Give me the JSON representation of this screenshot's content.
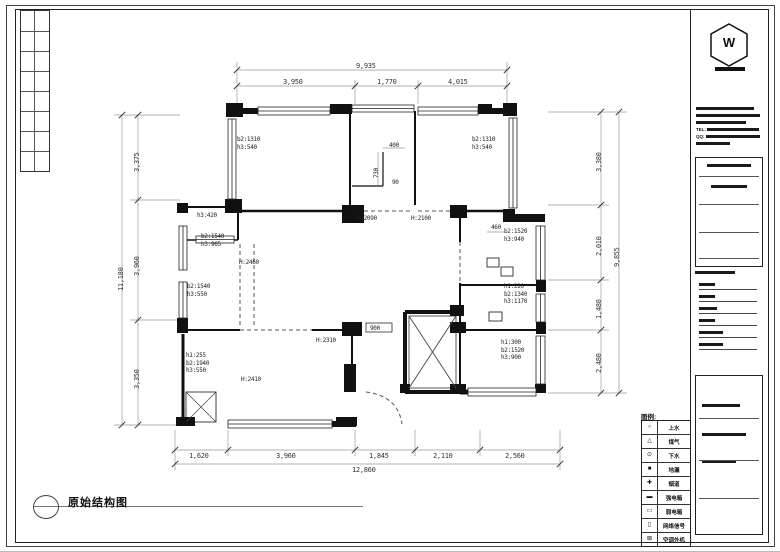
{
  "sheet": {
    "drawing_title": "原始结构图",
    "legend_header": "图例:"
  },
  "title_block": {
    "logo_glyph": "W",
    "tel_label": "TEL:",
    "qq_label": "QQ:"
  },
  "legend_rows": [
    {
      "sym": "○",
      "name": "上水"
    },
    {
      "sym": "△",
      "name": "煤气"
    },
    {
      "sym": "⊙",
      "name": "下水"
    },
    {
      "sym": "■",
      "name": "地漏"
    },
    {
      "sym": "✚",
      "name": "烟道"
    },
    {
      "sym": "▬",
      "name": "强电箱"
    },
    {
      "sym": "▭",
      "name": "弱电箱"
    },
    {
      "sym": "▯",
      "name": "网络信号"
    },
    {
      "sym": "⊠",
      "name": "空调外机"
    }
  ],
  "plan": {
    "labels": [
      {
        "t": "b2:1310\nh3:540",
        "x": 237,
        "y": 136
      },
      {
        "t": "b2:1310\nh3:540",
        "x": 472,
        "y": 136
      },
      {
        "t": "h3:420",
        "x": 197,
        "y": 212
      },
      {
        "t": "b2:1540\nh3:965",
        "x": 201,
        "y": 233
      },
      {
        "t": "H:2460",
        "x": 239,
        "y": 259
      },
      {
        "t": "b2:1540\nh3:550",
        "x": 187,
        "y": 283
      },
      {
        "t": "H:2090",
        "x": 357,
        "y": 215
      },
      {
        "t": "H:2100",
        "x": 411,
        "y": 215
      },
      {
        "t": "b2:1520\nh3:940",
        "x": 504,
        "y": 228
      },
      {
        "t": "h1:220\nb2:1340\nh3:1170",
        "x": 504,
        "y": 283
      },
      {
        "t": "h1:300\nb2:1520\nh3:900",
        "x": 501,
        "y": 339
      },
      {
        "t": "h1:255\nb2:1940\nh3:550",
        "x": 186,
        "y": 352
      },
      {
        "t": "H:2410",
        "x": 241,
        "y": 376
      },
      {
        "t": "H:2310",
        "x": 316,
        "y": 337
      },
      {
        "t": "400",
        "x": 389,
        "y": 142
      },
      {
        "t": "730",
        "x": 373,
        "y": 178,
        "rot": true
      },
      {
        "t": "90",
        "x": 392,
        "y": 179
      },
      {
        "t": "460",
        "x": 491,
        "y": 224
      },
      {
        "t": "900",
        "x": 370,
        "y": 325
      }
    ],
    "dims": [
      {
        "t": "9,935",
        "x": 356,
        "y": 62
      },
      {
        "t": "3,950",
        "x": 283,
        "y": 78
      },
      {
        "t": "1,770",
        "x": 377,
        "y": 78
      },
      {
        "t": "4,015",
        "x": 448,
        "y": 78
      },
      {
        "t": "11,180",
        "x": 117,
        "y": 291,
        "rot": true
      },
      {
        "t": "3,375",
        "x": 133,
        "y": 172,
        "rot": true
      },
      {
        "t": "3,960",
        "x": 133,
        "y": 276,
        "rot": true
      },
      {
        "t": "3,350",
        "x": 133,
        "y": 389,
        "rot": true
      },
      {
        "t": "3,380",
        "x": 595,
        "y": 172,
        "rot": true
      },
      {
        "t": "2,010",
        "x": 595,
        "y": 256,
        "rot": true
      },
      {
        "t": "1,480",
        "x": 595,
        "y": 319,
        "rot": true
      },
      {
        "t": "2,480",
        "x": 595,
        "y": 373,
        "rot": true
      },
      {
        "t": "9,855",
        "x": 613,
        "y": 267,
        "rot": true
      },
      {
        "t": "1,620",
        "x": 189,
        "y": 452
      },
      {
        "t": "3,960",
        "x": 276,
        "y": 452
      },
      {
        "t": "1,845",
        "x": 369,
        "y": 452
      },
      {
        "t": "2,110",
        "x": 433,
        "y": 452
      },
      {
        "t": "2,560",
        "x": 505,
        "y": 452
      },
      {
        "t": "12,860",
        "x": 352,
        "y": 466
      }
    ]
  }
}
